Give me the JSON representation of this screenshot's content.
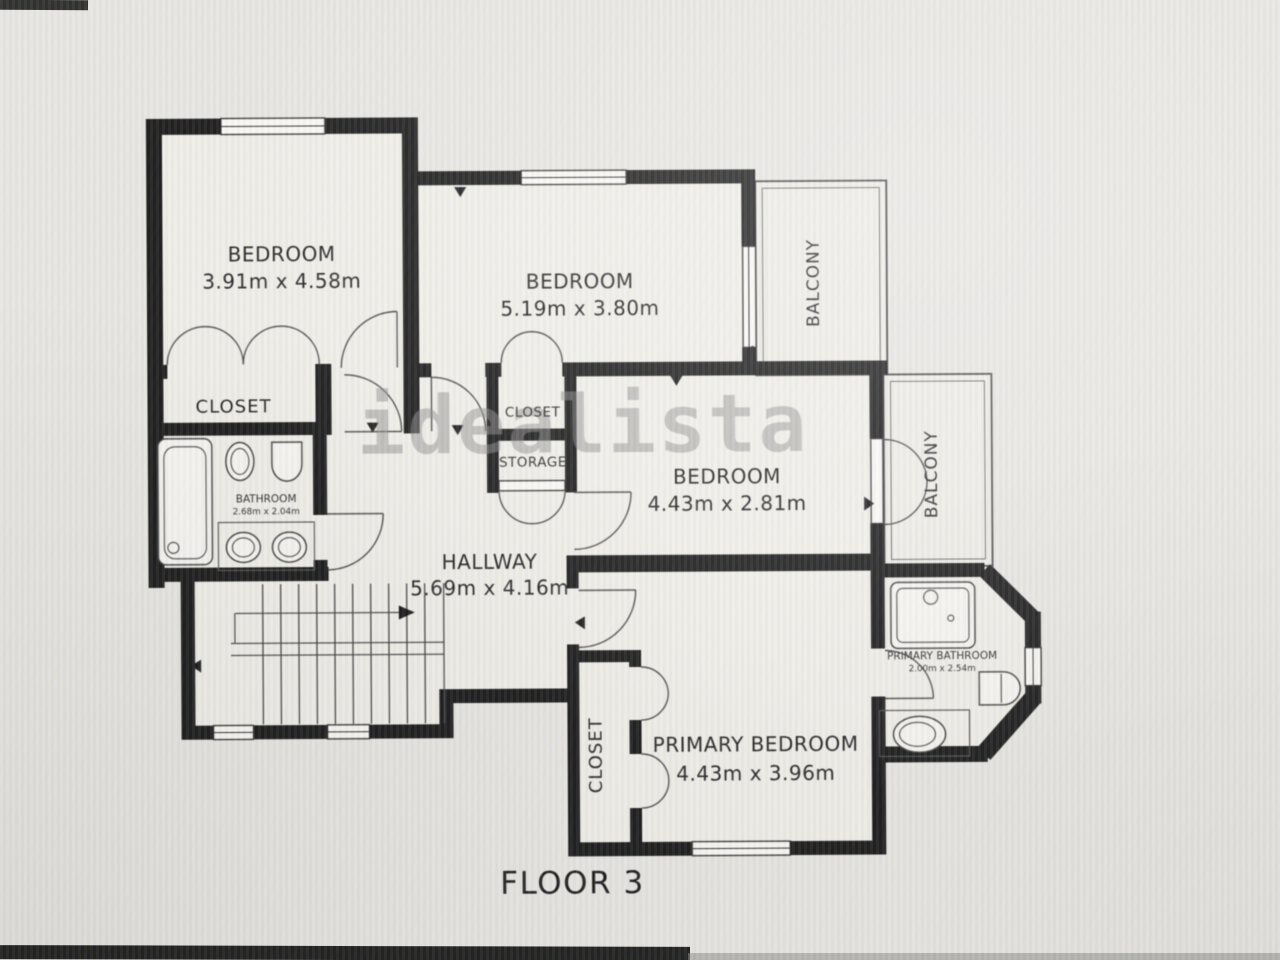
{
  "photo": {
    "floor_label": "FLOOR 3",
    "watermark": "idealista"
  },
  "rooms": {
    "bedroom_top_left": {
      "name": "BEDROOM",
      "dims": "3.91m x 4.58m"
    },
    "bedroom_top_middle": {
      "name": "BEDROOM",
      "dims": "5.19m x 3.80m"
    },
    "bedroom_middle_right": {
      "name": "BEDROOM",
      "dims": "4.43m x 2.81m"
    },
    "primary_bedroom": {
      "name": "PRIMARY BEDROOM",
      "dims": "4.43m x 3.96m"
    },
    "hallway": {
      "name": "HALLWAY",
      "dims": "5.69m x 4.16m"
    },
    "bathroom": {
      "name": "BATHROOM",
      "dims": "2.68m x 2.04m"
    },
    "primary_bathroom": {
      "name": "PRIMARY BATHROOM",
      "dims": "2.00m x 2.54m"
    },
    "closet_bedroom_top_left": {
      "name": "CLOSET"
    },
    "closet_hall": {
      "name": "CLOSET"
    },
    "storage": {
      "name": "STORAGE"
    },
    "closet_primary": {
      "name": "CLOSET"
    },
    "balcony_top": {
      "name": "BALCONY"
    },
    "balcony_right": {
      "name": "BALCONY"
    }
  }
}
